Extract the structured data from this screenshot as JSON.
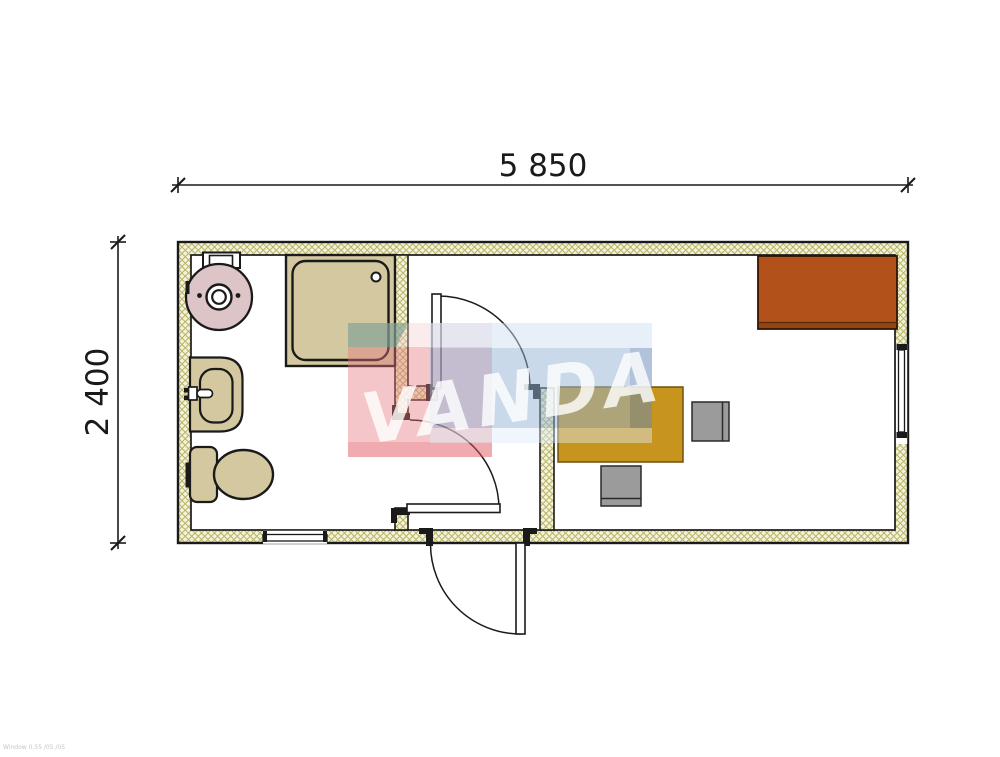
{
  "drawing": {
    "type": "floor-plan",
    "dimensions": {
      "width_label": "5 850",
      "height_label": "2 400"
    },
    "watermark": {
      "text": "VANDA"
    },
    "corner_note": "Window 0,55 /05 /05",
    "rooms": {
      "bathroom_fixtures": [
        "water-heater",
        "shower-tray",
        "washbasin",
        "toilet"
      ],
      "office_furniture": [
        "wardrobe",
        "desk",
        "chair",
        "chair"
      ],
      "openings": {
        "doors": 3,
        "windows": 2
      }
    }
  },
  "colors": {
    "outline": "#1a1a1a",
    "wall_fill": "#f4f2da",
    "wall_hatch_line": "#b7b566",
    "fixture_tan": "#d3c89f",
    "boiler_pink": "#dcc4c7",
    "desk_ochre": "#c7941d",
    "desk_border": "#6e520f",
    "wardrobe_orange": "#b25119",
    "wardrobe_border": "#2e1506",
    "chair_gray": "#9b9b9b",
    "chair_border": "#2a2a2a",
    "logo_red_front": "rgba(232,120,126,0.42)",
    "logo_red_top": "rgba(242,205,210,0.40)",
    "logo_red_bottom": "rgba(226,88,98,0.50)",
    "logo_teal": "rgba(90,145,130,0.50)",
    "logo_blue_top": "rgba(208,226,242,0.50)",
    "logo_blue_front": "rgba(148,180,214,0.50)",
    "logo_blue_side": "rgba(106,138,184,0.52)",
    "logo_blue_bottom": "rgba(222,234,246,0.45)",
    "logo_text": "rgba(255,255,255,0.80)"
  }
}
